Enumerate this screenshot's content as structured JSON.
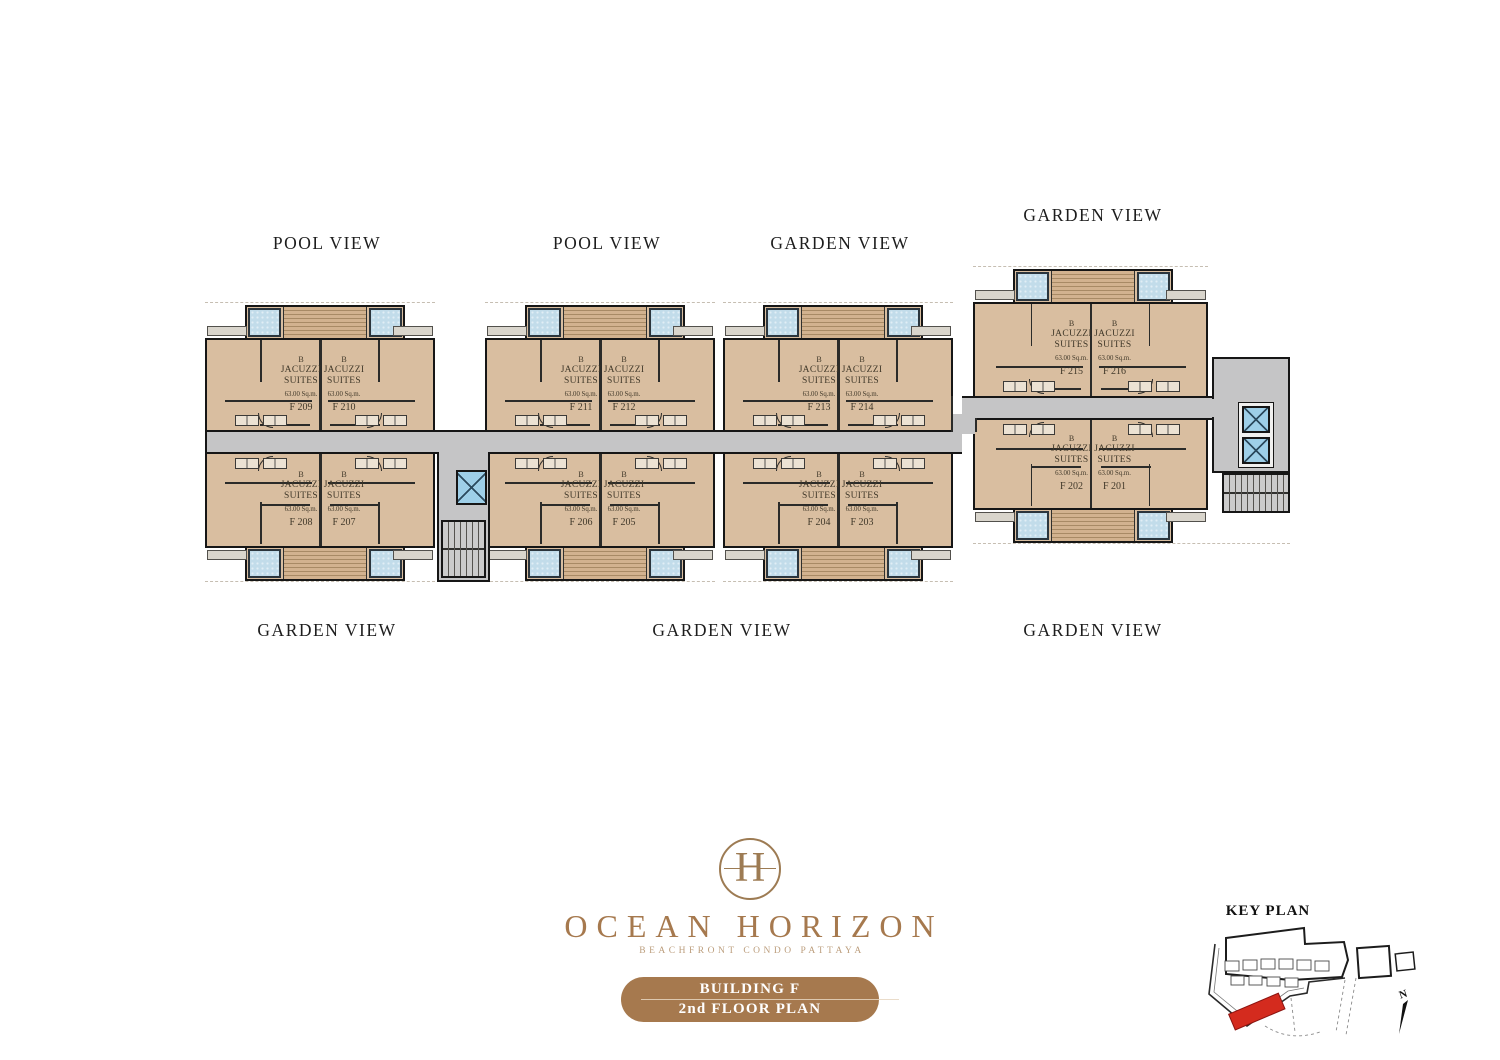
{
  "brand": {
    "monogram": "H",
    "name": "OCEAN HORIZON",
    "tagline": "BEACHFRONT CONDO PATTAYA"
  },
  "badge": {
    "line1": "BUILDING F",
    "line2": "2nd FLOOR PLAN"
  },
  "view_labels": [
    "POOL VIEW",
    "POOL VIEW",
    "GARDEN VIEW",
    "GARDEN VIEW",
    "GARDEN VIEW",
    "GARDEN VIEW",
    "GARDEN VIEW"
  ],
  "unit_common": {
    "type": "B",
    "name_line1": "JACUZZI",
    "name_line2": "SUITES",
    "area": "63.00 Sq.m."
  },
  "units": [
    {
      "number": "F 209"
    },
    {
      "number": "F 210"
    },
    {
      "number": "F 208"
    },
    {
      "number": "F 207"
    },
    {
      "number": "F 211"
    },
    {
      "number": "F 212"
    },
    {
      "number": "F 206"
    },
    {
      "number": "F 205"
    },
    {
      "number": "F 213"
    },
    {
      "number": "F 214"
    },
    {
      "number": "F 204"
    },
    {
      "number": "F 203"
    },
    {
      "number": "F 215"
    },
    {
      "number": "F 216"
    },
    {
      "number": "F 202"
    },
    {
      "number": "F 201"
    }
  ],
  "key_plan": {
    "title": "KEY PLAN",
    "north_label": "N",
    "highlight_color": "#d42b1e"
  },
  "colors": {
    "unit_floor": "#d9bea0",
    "corridor": "#c5c5c6",
    "jacuzzi_pool": "#c2dcea",
    "wall": "#161616",
    "brand_brown": "#a6794e",
    "keyplan_highlight": "#d42b1e"
  }
}
